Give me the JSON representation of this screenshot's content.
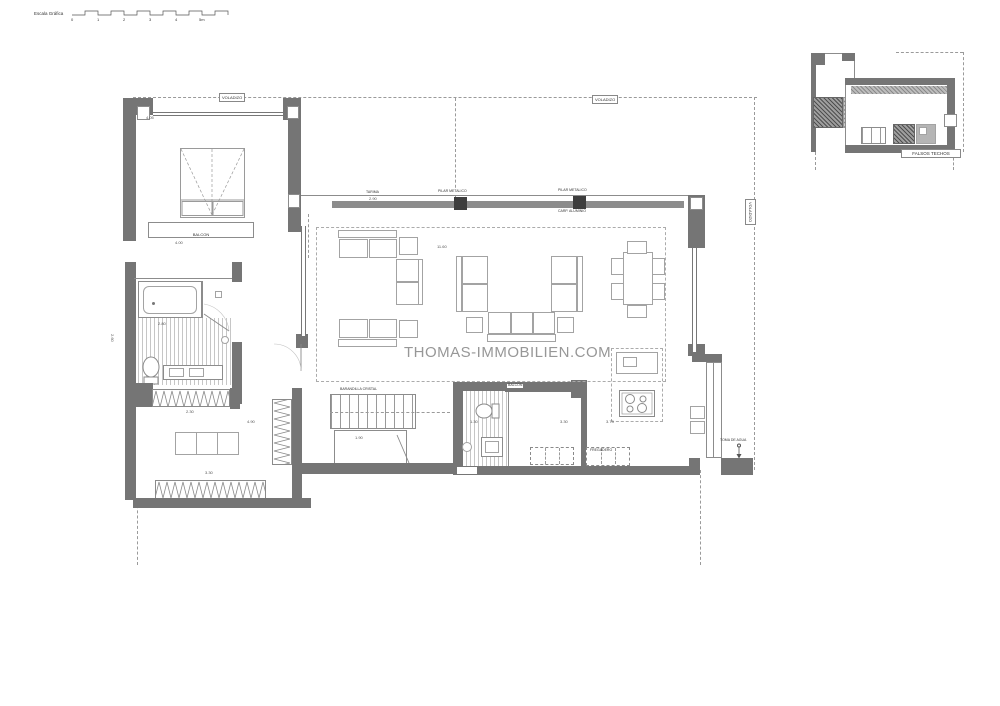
{
  "watermark": "THOMAS-IMMOBILIEN.COM",
  "scale_bar": {
    "label": "Escala Gráfica",
    "ticks": [
      "0",
      "1",
      "2",
      "3",
      "4",
      "5m"
    ]
  },
  "inset": {
    "label": "FALSOS TECHOS"
  },
  "labels": {
    "voladizo": "VOLADIZO",
    "balcon": "BALCON",
    "barandilla": "BARANDILLA CRISTAL",
    "pilar": "PILAR METALICO",
    "carpinteria": "CARP. ALUMINIO",
    "tarima": "TARIMA",
    "toma_agua": "TOMA DE AGUA",
    "fregadero": "FREGADERO"
  },
  "dims": {
    "bedroom": "4.05",
    "balcony": "4.00",
    "bath": "2.80",
    "left_side": "2.60",
    "tarima_height": "2.90",
    "living": "11.60",
    "hall": "1.90",
    "bath2": "1.30",
    "room2": "3.30",
    "kitchen": "3.73",
    "dressing_top": "2.30",
    "dressing_right": "4.90",
    "dressing_bottom": "3.30"
  }
}
